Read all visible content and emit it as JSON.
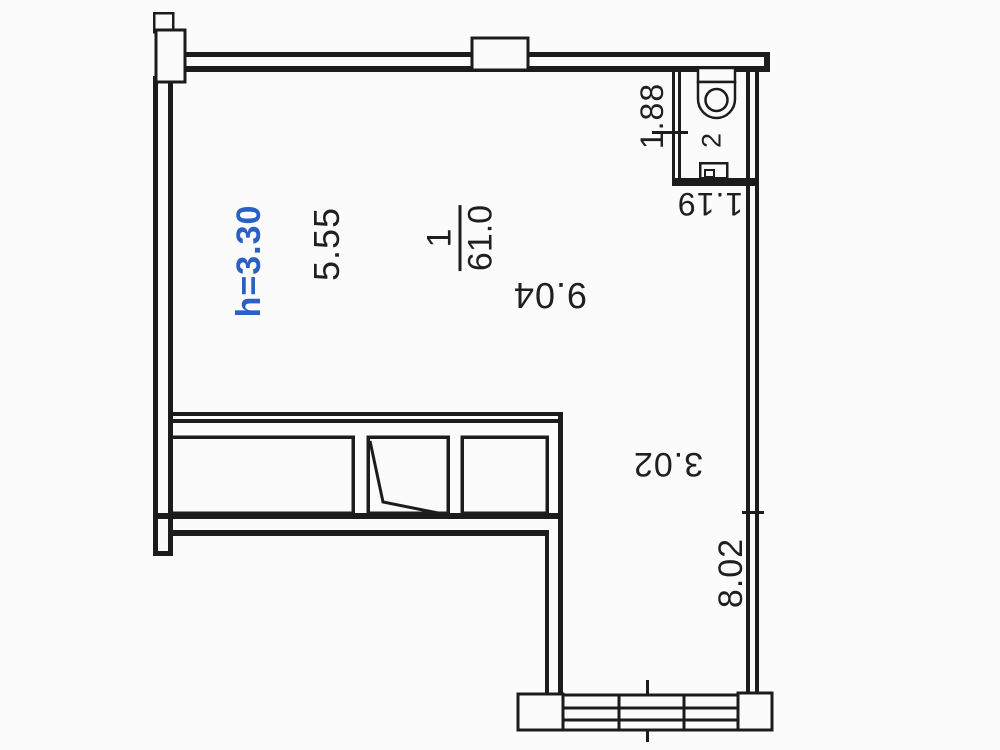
{
  "plan": {
    "title": "apartment-floor-plan",
    "height_label": "h=3.30",
    "main_room": {
      "number": "1",
      "area": "61.0",
      "dim_width": "9.04",
      "dim_width_partial": "5.55"
    },
    "bathroom": {
      "number": "2",
      "dim_width": "1.88",
      "dim_exit": "1.19"
    },
    "corridor": {
      "dim_width": "3.02",
      "dim_length": "8.02"
    },
    "icons": [
      "toilet-icon",
      "window-icon",
      "door-swing-icon"
    ],
    "colors": {
      "line": "#1c1c1c",
      "height_label_accent": "#2a5fc4",
      "background": "#fbfbfb",
      "text": "#1f1f1f"
    }
  }
}
